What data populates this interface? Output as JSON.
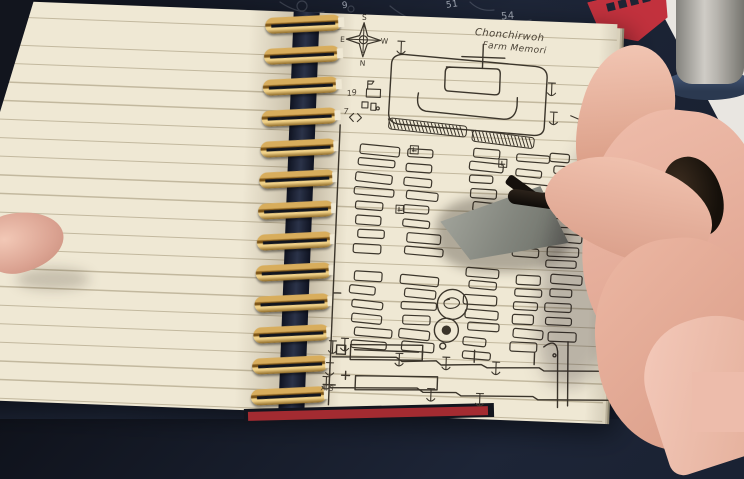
{
  "scene": {
    "width": 744,
    "height": 419,
    "description": "hand drawing a cemetery-style map in a gold spiral notebook on a dark tool mat"
  },
  "colors": {
    "mat": "#1c2334",
    "paper": "#efe8d4",
    "spiral_gold": "#c59a4e",
    "logo_red": "#c2313d",
    "ink": "#3b352b",
    "skin": "#ecbaa8",
    "strip_red": "#a32b31"
  },
  "mat": {
    "numbers": [
      {
        "t": "9",
        "x": 342,
        "y": 1,
        "s": 9,
        "c": "#b9c0cc",
        "r": -5
      },
      {
        "t": "51",
        "x": 446,
        "y": 0,
        "s": 9,
        "c": "#b9c0cc",
        "r": -8
      },
      {
        "t": "54",
        "x": 501,
        "y": 11,
        "s": 10,
        "c": "#b9c0cc",
        "r": -4
      },
      {
        "t": "57",
        "x": 645,
        "y": 58,
        "s": 9,
        "c": "#b9c0cc",
        "r": 3
      },
      {
        "t": "58",
        "x": 606,
        "y": 87,
        "s": 9,
        "c": "#b9c0cc",
        "r": 3
      },
      {
        "t": "60",
        "x": 589,
        "y": 128,
        "s": 8,
        "c": "#dfe3e8",
        "r": 3
      },
      {
        "t": "37",
        "x": 572,
        "y": 130,
        "s": 8,
        "c": "#6a6458",
        "r": 3
      }
    ]
  },
  "map": {
    "title_line1": "Chonchirwoh",
    "title_line2": "Farm Memori",
    "compass": {
      "top": "S",
      "bottom": "N",
      "left": "E",
      "right": "W"
    },
    "labels": [
      {
        "t": "19",
        "x": 343,
        "y": 101,
        "s": 8,
        "r": -12
      },
      {
        "t": "7",
        "x": 340,
        "y": 119,
        "s": 8,
        "r": -5
      },
      {
        "t": "A.G",
        "x": 328,
        "y": 396,
        "s": 7,
        "r": 0
      }
    ]
  },
  "drawing": {
    "columns": [
      {
        "x": 356,
        "w": 34,
        "y0": 148,
        "y1": 352,
        "gap": [
          252,
          266
        ]
      },
      {
        "x": 406,
        "w": 34,
        "y0": 151,
        "y1": 352,
        "gap": [
          252,
          266
        ]
      },
      {
        "x": 470,
        "w": 30,
        "y0": 148,
        "y1": 352,
        "gap": [
          252,
          266
        ]
      },
      {
        "x": 516,
        "w": 28,
        "y0": 152,
        "y1": 352,
        "gap": [
          252,
          266
        ]
      },
      {
        "x": 550,
        "w": 26,
        "y0": 150,
        "y1": 340,
        "gap": []
      }
    ],
    "hatches": [
      {
        "x": 386,
        "y": 121,
        "w": 78,
        "h": 11,
        "rot": 4
      },
      {
        "x": 470,
        "y": 130,
        "w": 62,
        "h": 11,
        "rot": 5
      }
    ],
    "markers": [
      [
        408,
        148
      ],
      [
        497,
        158
      ],
      [
        396,
        208
      ]
    ],
    "anchors": [
      [
        395,
        50
      ],
      [
        547,
        86
      ],
      [
        550,
        115
      ],
      [
        350,
        349
      ],
      [
        338,
        352
      ],
      [
        336,
        374
      ],
      [
        405,
        362
      ],
      [
        452,
        364
      ],
      [
        502,
        367
      ],
      [
        438,
        396
      ],
      [
        487,
        399
      ],
      [
        333,
        388
      ]
    ]
  },
  "spiral": {
    "count": 13
  }
}
